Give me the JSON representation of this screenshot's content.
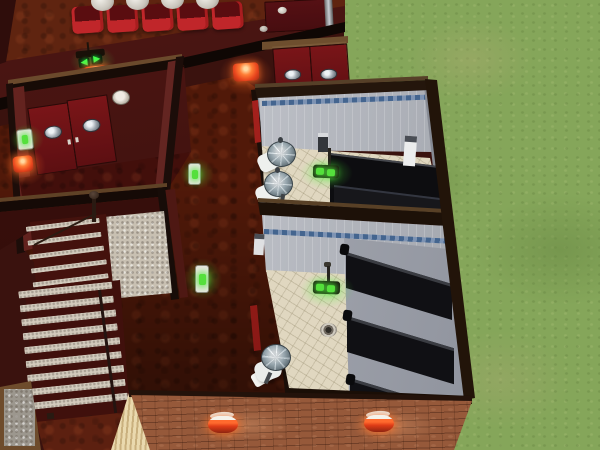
{
  "meta": {
    "description": "Isometric cutaway view of a life-simulation game lot: red lounge interior with seating, exit sign and sconces, entry vestibule with red porthole double doors, open staircase, two white-tiled public bathrooms with dark toilet stalls and chrome pedestal sinks, brick exterior wall with lanterns, and a grass lawn.",
    "view": "top-down isometric cutaway",
    "resolution": "600x450"
  },
  "palette": {
    "background_maroon": "#3a120e",
    "carpet_rust": "#5f2410",
    "hall_floor": "#511909",
    "wall_face_red": "#4a1512",
    "wall_cut_dark": "#170b06",
    "wood_trim": "#6b4a2c",
    "door_red": "#6e1215",
    "seat_red": "#c32a28",
    "dome_white": "#f0eee8",
    "bathroom_wall_gray": "#c3c6cd",
    "tile_stripe_blue": "#5b77a0",
    "bathroom_floor_beige": "#e0d7c0",
    "stall_black": "#101014",
    "chrome": "#aebec6",
    "brick": "#96593a",
    "siding_beige": "#ead9ae",
    "lamp_orange": "#ff6a2e",
    "indicator_green": "#48e636",
    "grass_green": "#85a65a",
    "step_concrete": "#d2cabc"
  },
  "icons": {
    "exit_arrow_left": "◀",
    "exit_arrow_right": "▶"
  },
  "objects": {
    "grass": "grass lawn",
    "theater": "red lounge room floor",
    "seat": "red theater seat",
    "dome": "white dome cover",
    "exit_sign": "exit sign with green arrows",
    "wall_lamp": "glowing orange wall sconce",
    "porthole_doors": "red double doors with porthole windows",
    "panel_door": "red panel door with push bar",
    "smoke_detector": "smoke detector",
    "light_switch": "light switch with green indicator",
    "staircase": "open staircase",
    "handrail": "stair handrail",
    "newel_post": "stair newel post",
    "landing": "speckled stair landing",
    "framed_art": "framed artwork",
    "siding": "beige siding wall edge",
    "brick_wall": "exterior brick wall",
    "brick_lamp": "exterior wall lantern",
    "bathroom_upper": "upper bathroom",
    "bathroom_lower": "lower bathroom",
    "pedestal_sink": "chrome pedestal sink",
    "stall_block": "dark toilet stall",
    "stall_door": "dark stall door",
    "stall_post": "stall partition post",
    "floor_drain": "floor drain",
    "towel_dispenser": "towel dispenser",
    "soap_dispenser": "soap dispenser",
    "floor_light": "floor light with green glow",
    "door_sliver": "red door seen edge-on",
    "wall_knob": "metal door knob"
  }
}
